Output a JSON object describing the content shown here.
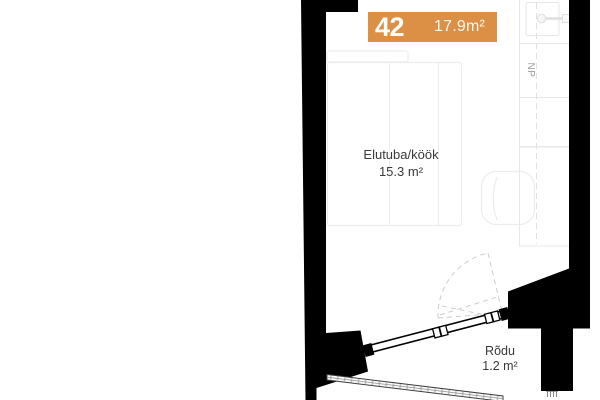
{
  "unit_badge": {
    "number": "42",
    "area": "17.9m²"
  },
  "rooms": {
    "living": {
      "name": "Elutuba/köök",
      "area": "15.3 m²"
    },
    "balcony": {
      "name": "Rõdu",
      "area": "1.2 m²"
    }
  },
  "annotations": {
    "np_label": "NP"
  },
  "icons": {
    "door_swing": "door-swing-arc",
    "radiator": "radiator-icon",
    "shaft_fixture": "shaft-fixture-icon"
  },
  "colors": {
    "badge_bg": "#DC9045",
    "badge_text": "#FFFFFF",
    "wall": "#000000",
    "label_text": "#3A3A3A",
    "muted_label": "#9A9A9A",
    "furniture_line": "#EDEDED",
    "shaft_line": "#E7E7E7",
    "door_dash": "#CCCCCC"
  }
}
